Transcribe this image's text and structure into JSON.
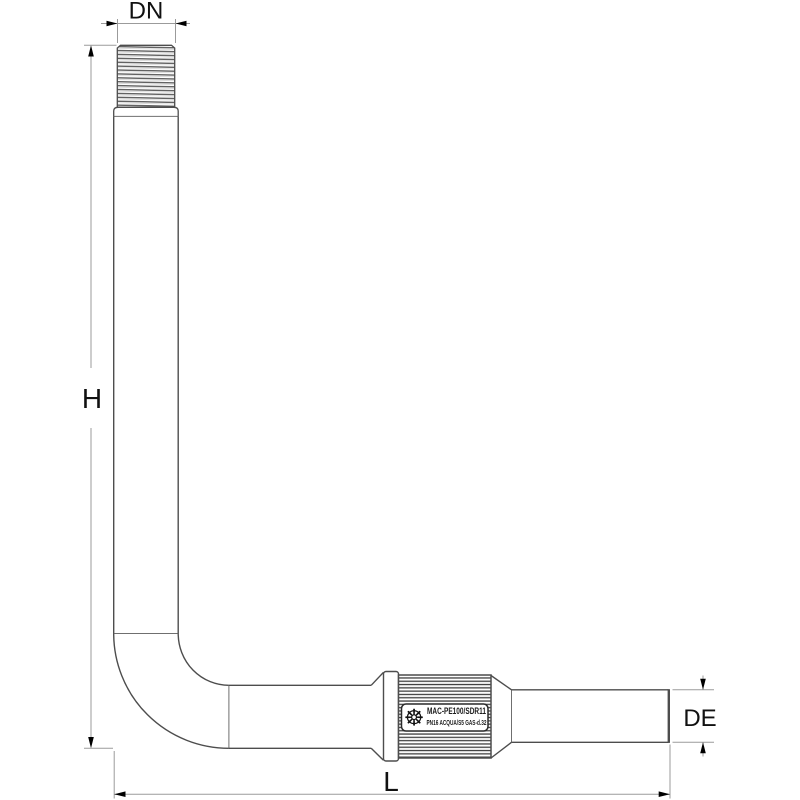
{
  "drawing": {
    "kind": "technical-drawing-pipe-elbow-fitting",
    "dimensions": {
      "top_width_label": "DN",
      "height_label": "H",
      "length_label": "L",
      "end_diameter_label": "DE"
    },
    "coupling_marking": {
      "logo_glyph": "☸",
      "line1": "MAC-PE100/SDR11",
      "line2": "PN16 ACQUA/S5 GAS-d.32"
    },
    "colors": {
      "background": "#ffffff",
      "outline": "#4d4d4d",
      "joint_line": "#6f6f6f",
      "dimension_line": "#9b9b9b",
      "arrow": "#000000",
      "text": "#111111"
    }
  }
}
